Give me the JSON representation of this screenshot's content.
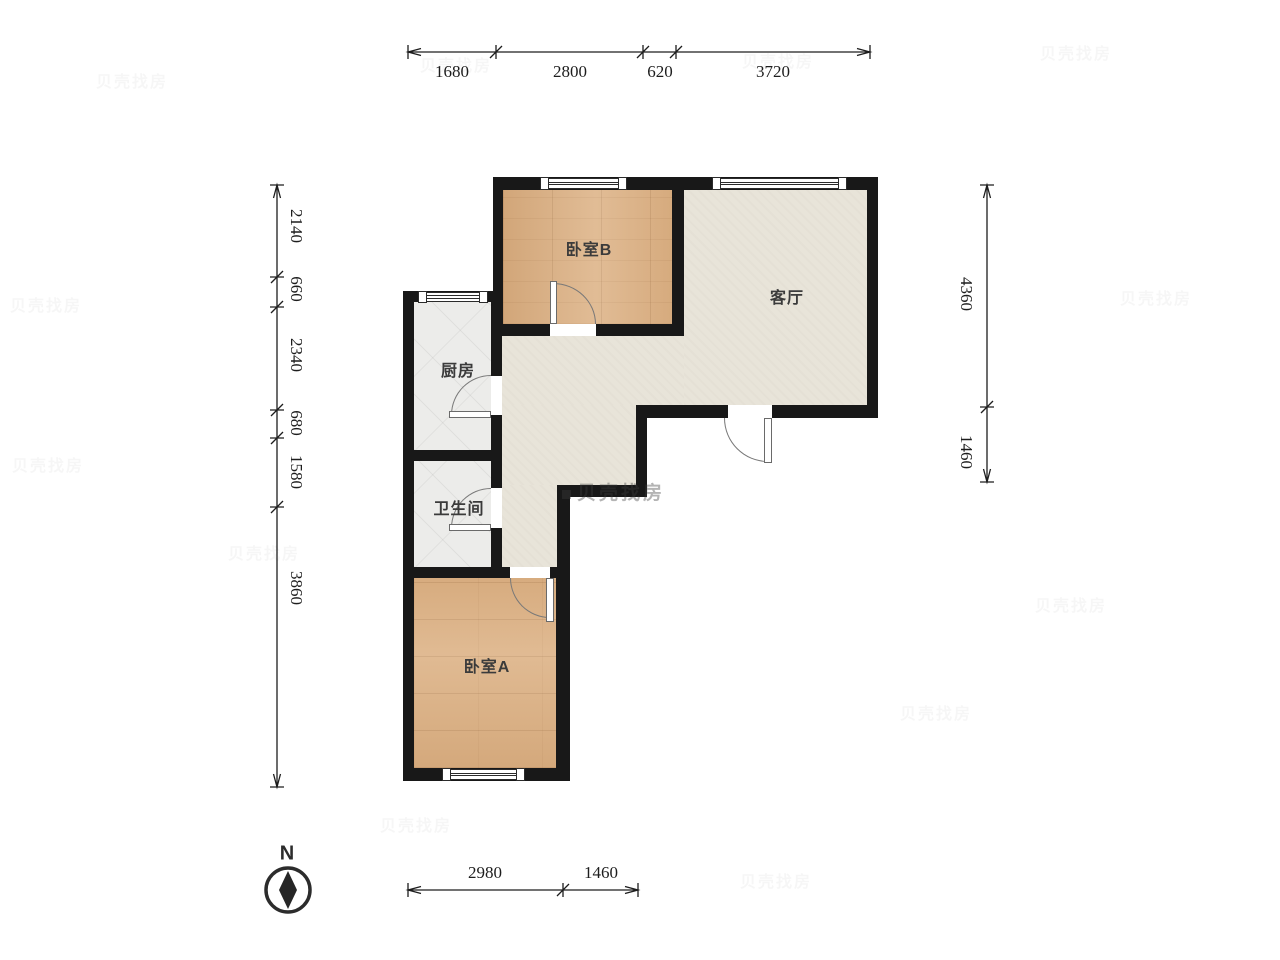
{
  "floor_plan": {
    "rooms": [
      {
        "id": "bedroom-b",
        "label": "卧室B",
        "floor": "wood"
      },
      {
        "id": "living-room",
        "label": "客厅",
        "floor": "laminate"
      },
      {
        "id": "kitchen",
        "label": "厨房",
        "floor": "tile"
      },
      {
        "id": "bathroom",
        "label": "卫生间",
        "floor": "tile"
      },
      {
        "id": "bedroom-a",
        "label": "卧室A",
        "floor": "wood"
      }
    ],
    "dimensions_mm": {
      "top": [
        "1680",
        "2800",
        "620",
        "3720"
      ],
      "left": [
        "2140",
        "660",
        "2340",
        "680",
        "1580",
        "3860"
      ],
      "right": [
        "4360",
        "1460"
      ],
      "bottom": [
        "2980",
        "1460"
      ]
    },
    "compass": {
      "label": "N"
    },
    "watermark": {
      "text": "贝壳找房"
    },
    "colors": {
      "wall": "#181818",
      "wood": "#dcb184",
      "tile": "#ececea",
      "laminate": "#e8e4d9",
      "dim_text": "#1d1d1d",
      "label_text": "#3b3b3b"
    }
  }
}
